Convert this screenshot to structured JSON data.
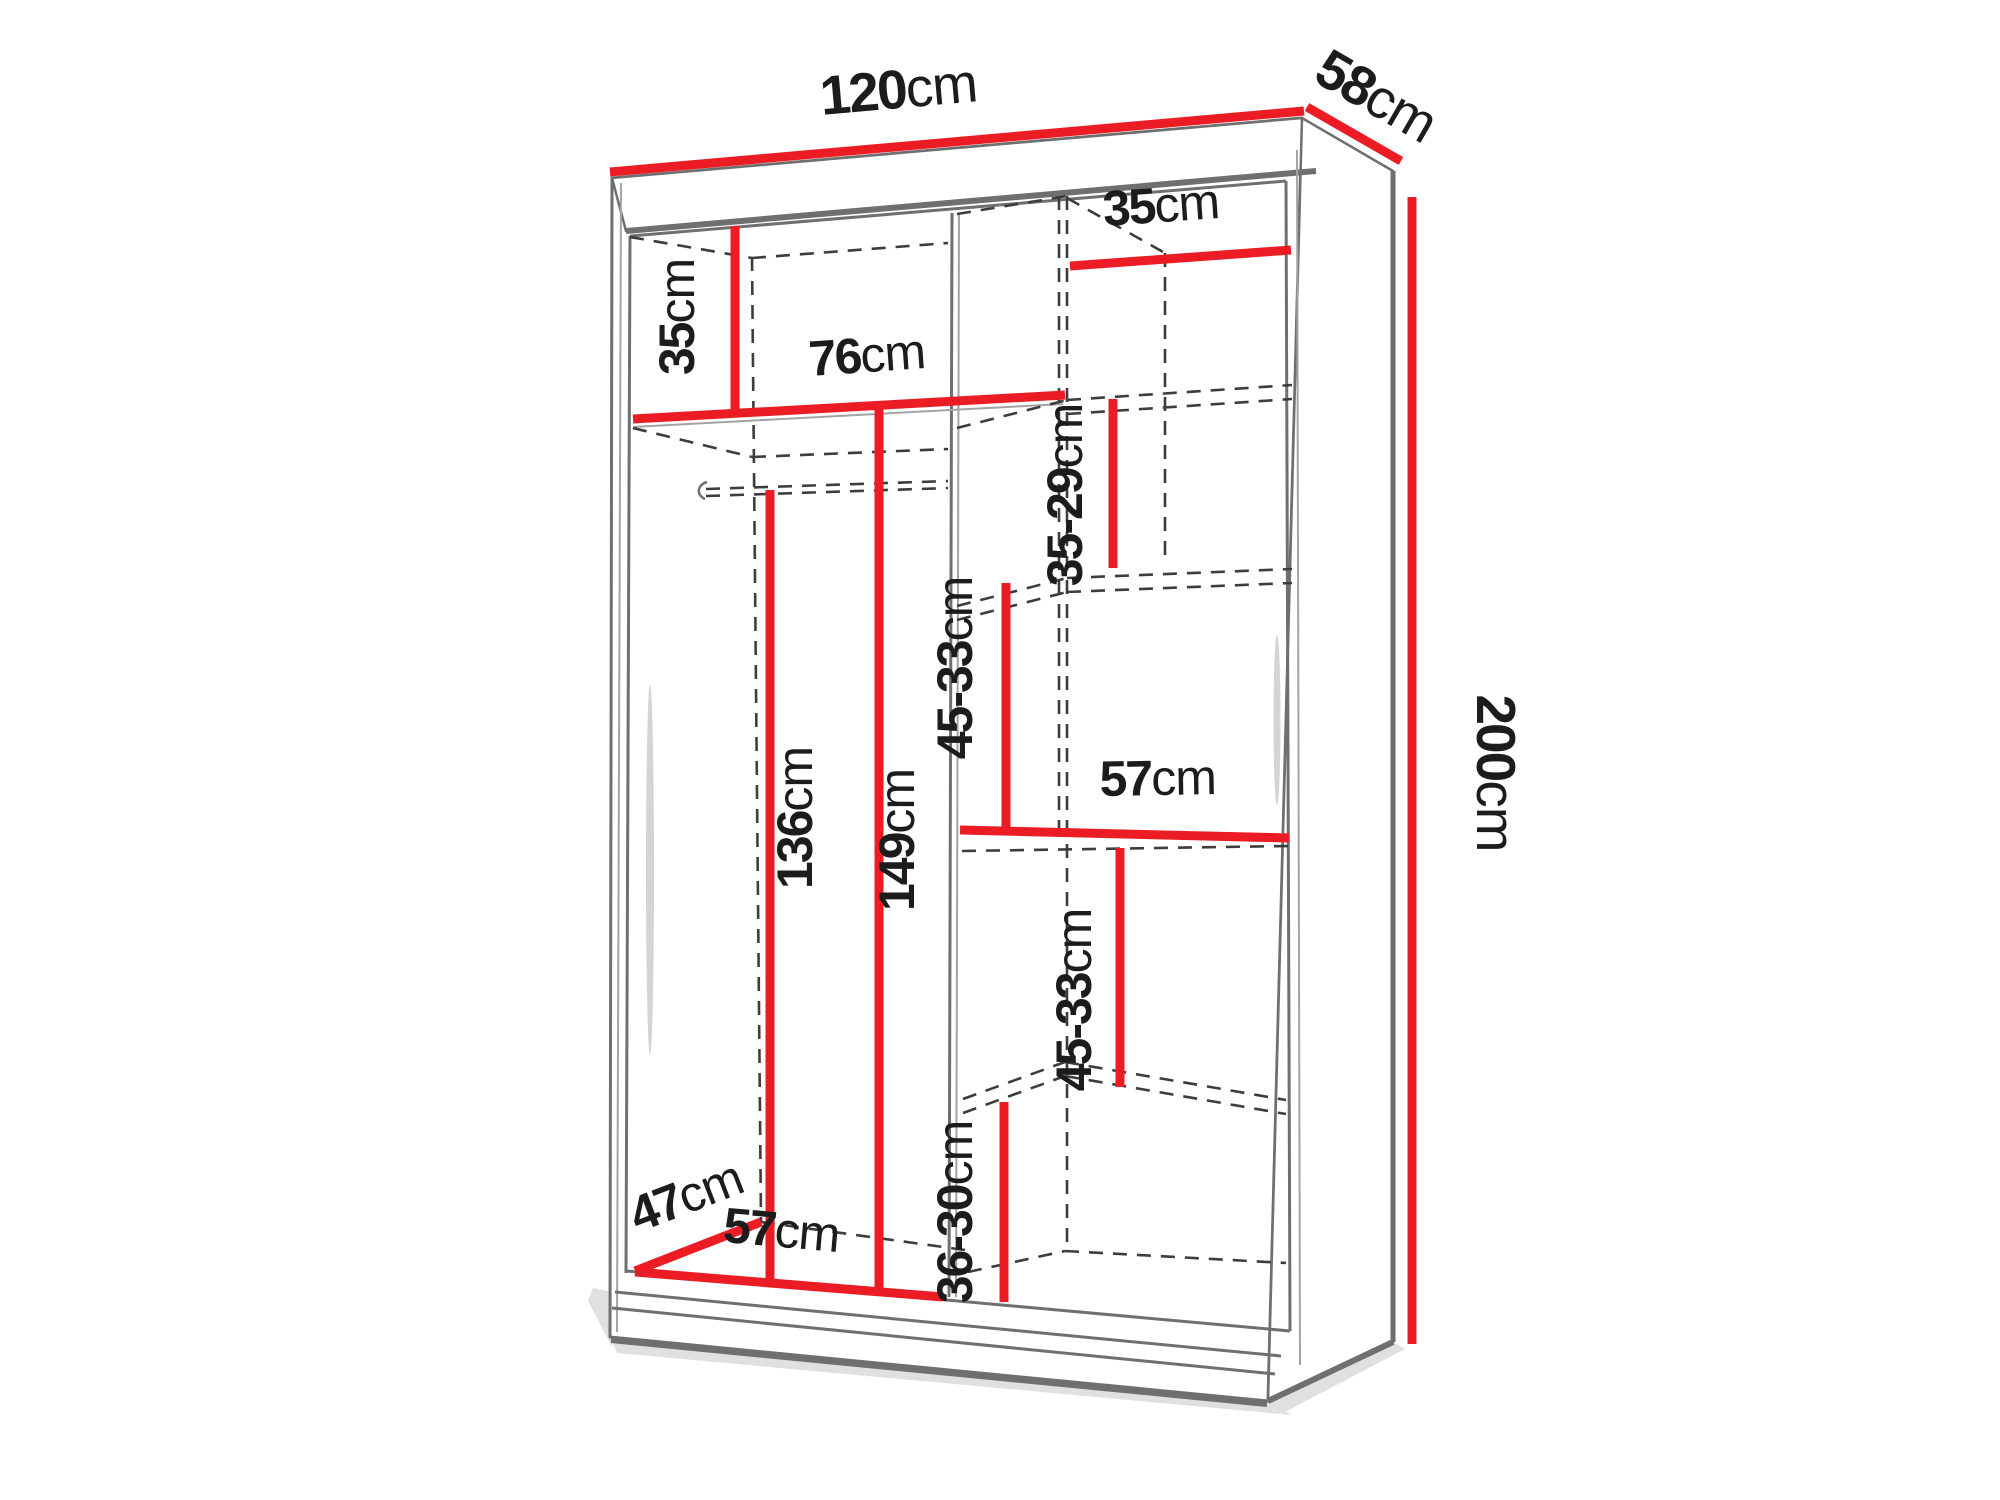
{
  "diagram": {
    "type": "wardrobe-interior-dimension-diagram",
    "colors": {
      "dimension_line": "#ec1c24",
      "outline": "#6f6f6f",
      "hidden_line": "#3d3d3d",
      "label_text": "#1c1c1c",
      "background": "#ffffff"
    },
    "dims": {
      "width_top": {
        "num": "120",
        "unit": "cm"
      },
      "depth_top": {
        "num": "58",
        "unit": "cm"
      },
      "height_right": {
        "num": "200",
        "unit": "cm"
      },
      "left_upper_height": {
        "num": "35",
        "unit": "cm"
      },
      "upper_shelf_width": {
        "num": "76",
        "unit": "cm"
      },
      "right_upper_width": {
        "num": "35",
        "unit": "cm"
      },
      "right_gap_1": {
        "num": "35-29",
        "unit": "cm"
      },
      "right_gap_2": {
        "num": "45-33",
        "unit": "cm"
      },
      "hanging_height": {
        "num": "136",
        "unit": "cm"
      },
      "left_height": {
        "num": "149",
        "unit": "cm"
      },
      "right_shelf_width": {
        "num": "57",
        "unit": "cm"
      },
      "right_gap_3": {
        "num": "45-33",
        "unit": "cm"
      },
      "right_bottom_gap": {
        "num": "36-30",
        "unit": "cm"
      },
      "bottom_depth": {
        "num": "47",
        "unit": "cm"
      },
      "bottom_width": {
        "num": "57",
        "unit": "cm"
      }
    }
  }
}
